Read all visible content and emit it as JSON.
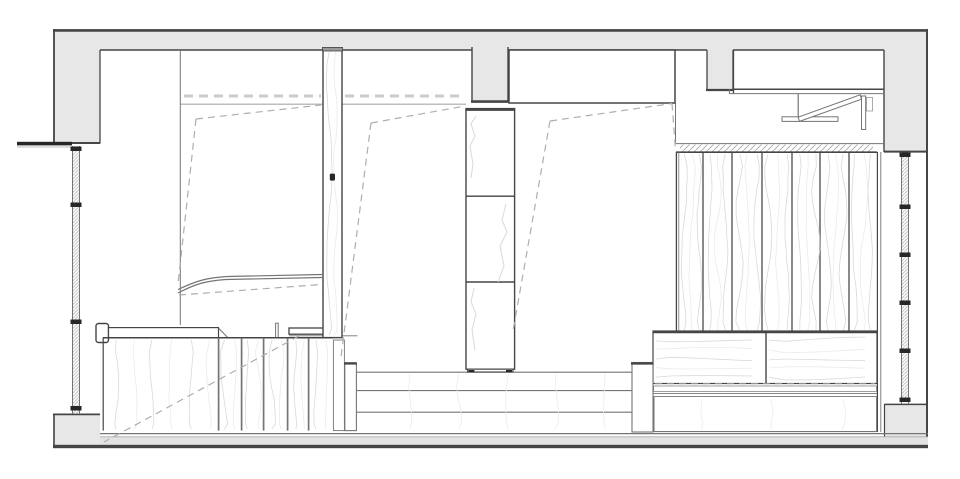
{
  "document": {
    "kind": "architectural-section-drawing",
    "description": "Black-and-white CAD cross-section of a small interior: concrete shell (hatched grey), two side windows, three room bays with dashed fold-down bed outlines, central tall cabinet on a stepped platform, left desk with cabinetry, right timber-slat wall over a bench, and a fold-away bracket under the upper-right cabinet.",
    "background": "#ffffff"
  },
  "colors": {
    "paper": "#ffffff",
    "wall_fill": "#e7e7e7",
    "outline_dark": "#454545",
    "outline_med": "#757575",
    "line_light": "#a9a9a9",
    "dash_hidden": "#aeaeae",
    "ceiling_dash": "#cbcbcb",
    "grain": "#d9d9d9",
    "grain_faint": "#ebebeb",
    "hatch": "#b3b3b3",
    "fitting": "#272727",
    "floor_fill": "#e3e3e3"
  },
  "components": [
    {
      "name": "ceiling-slab"
    },
    {
      "name": "left-wall"
    },
    {
      "name": "right-wall"
    },
    {
      "name": "floor-slab"
    },
    {
      "name": "left-window"
    },
    {
      "name": "right-window"
    },
    {
      "name": "window-head-flashing"
    },
    {
      "name": "mid-ceiling-pillar"
    },
    {
      "name": "right-ceiling-pillar"
    },
    {
      "name": "right-room-bulkhead-box"
    },
    {
      "name": "top-right-cabinet"
    },
    {
      "name": "fold-down-bracket"
    },
    {
      "name": "insulation-hatch-strip"
    },
    {
      "name": "timber-slat-wall"
    },
    {
      "name": "right-bench"
    },
    {
      "name": "bench-support"
    },
    {
      "name": "left-desk-counter"
    },
    {
      "name": "left-base-cabinet"
    },
    {
      "name": "wood-post"
    },
    {
      "name": "central-tall-cabinet"
    },
    {
      "name": "platform-steps"
    },
    {
      "name": "folded-bed-dashed-outline-left"
    },
    {
      "name": "folded-bed-dashed-outline-middle"
    },
    {
      "name": "folded-bed-dashed-outline-right"
    },
    {
      "name": "curved-rail"
    },
    {
      "name": "partition-line"
    }
  ]
}
